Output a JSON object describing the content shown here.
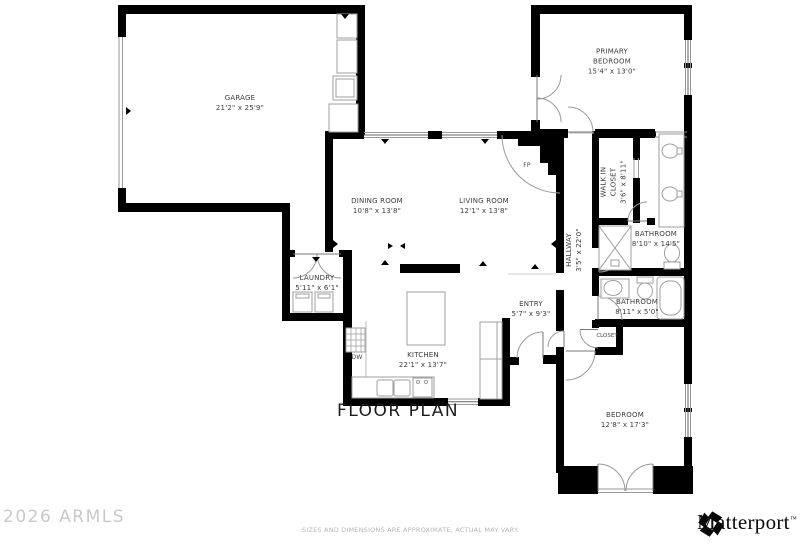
{
  "title": "FLOOR PLAN",
  "watermark": "2026 ARMLS",
  "disclaimer": "SIZES AND DIMENSIONS ARE APPROXIMATE, ACTUAL MAY VARY.",
  "brand": {
    "name": "Matterport",
    "trademark": "™"
  },
  "markers": {
    "fireplace": "FP",
    "dishwasher": "DW"
  },
  "rooms": {
    "garage": {
      "name": "GARAGE",
      "dims": "21'2\" x 25'9\""
    },
    "primary_bedroom": {
      "name": "PRIMARY BEDROOM",
      "dims": "15'4\" x 13'0\""
    },
    "dining_room": {
      "name": "DINING ROOM",
      "dims": "10'8\" x 13'8\""
    },
    "living_room": {
      "name": "LIVING ROOM",
      "dims": "12'1\" x 13'8\""
    },
    "walk_in_closet": {
      "name": "WALK IN CLOSET",
      "dims": "3'6\" x 8'11\""
    },
    "hallway": {
      "name": "HALLWAY",
      "dims": "3'5\" x 22'0\""
    },
    "primary_bathroom": {
      "name": "BATHROOM",
      "dims": "8'10\" x 14'5\""
    },
    "bathroom": {
      "name": "BATHROOM",
      "dims": "8'11\" x 5'0\""
    },
    "laundry": {
      "name": "LAUNDRY",
      "dims": "5'11\" x 6'1\""
    },
    "entry": {
      "name": "ENTRY",
      "dims": "5'7\" x 9'3\""
    },
    "kitchen": {
      "name": "KITCHEN",
      "dims": "22'1\" x 13'7\""
    },
    "closet": {
      "name": "CLOSET"
    },
    "bedroom": {
      "name": "BEDROOM",
      "dims": "12'8\" x 17'3\""
    }
  }
}
